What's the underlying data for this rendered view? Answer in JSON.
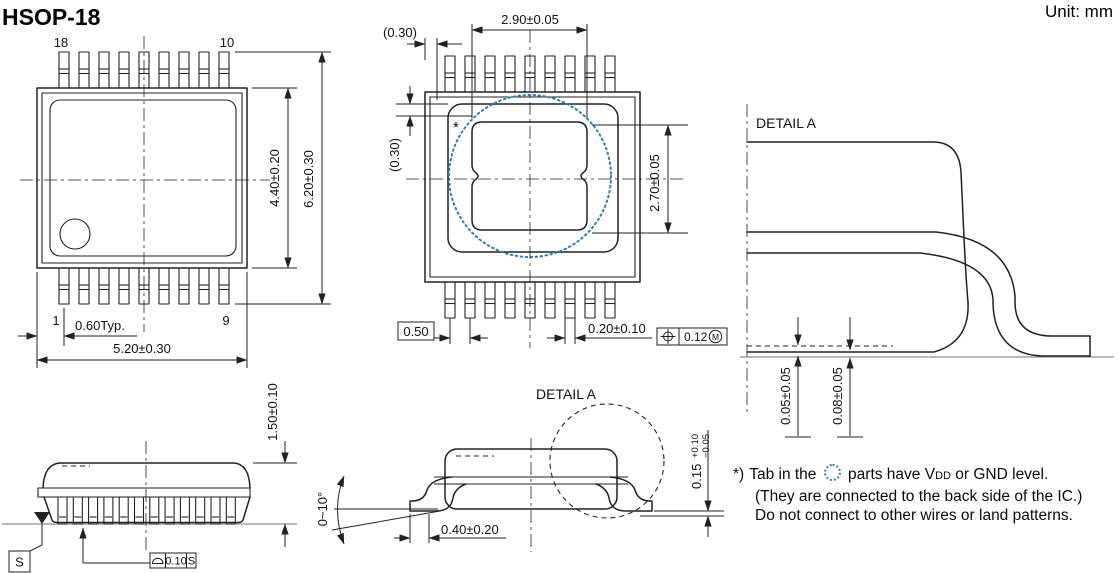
{
  "title": "HSOP-18",
  "unit_label": "Unit: mm",
  "colors": {
    "line": "#222222",
    "accent_blue": "#2e7eb3"
  },
  "top_view": {
    "pin_label_top_left": "18",
    "pin_label_top_right": "10",
    "pin_label_bottom_left": "1",
    "pin_label_bottom_right": "9",
    "dim_lead_offset": "0.60Typ.",
    "dim_overall_width": "5.20±0.30",
    "dim_body_depth": "4.40±0.20",
    "dim_overall_depth": "6.20±0.30"
  },
  "bottom_view": {
    "dim_pad_width": "2.90±0.05",
    "dim_edge_clearance_h": "(0.30)",
    "dim_edge_clearance_v": "(0.30)",
    "dim_pad_height": "2.70±0.05",
    "dim_lead_pitch": "0.50",
    "dim_lead_width": "0.20±0.10",
    "position_tolerance": "0.12",
    "position_modifier": "M",
    "asterisk_mark": "*"
  },
  "detail_a_view": {
    "label": "DETAIL A",
    "dim_standoff": "0.05±0.05",
    "dim_pad_standoff": "0.08±0.05"
  },
  "front_view": {
    "dim_height": "1.50±0.10",
    "datum_label": "S",
    "flatness_tolerance": "0.10",
    "flatness_datum": "S"
  },
  "side_view": {
    "detail_label": "DETAIL A",
    "dim_lead_angle": "0~10°",
    "dim_foot_length": "0.40±0.20",
    "dim_lead_thickness": "0.15",
    "dim_lead_thickness_plus": "+0.10",
    "dim_lead_thickness_minus": "−0.05"
  },
  "note": {
    "prefix": "*)",
    "line1_before": "Tab in the",
    "line1_after": "parts have V",
    "line1_subscript": "DD",
    "line1_end": "or GND level.",
    "line2": "(They are connected to the back side of the IC.)",
    "line3": "Do not connect to other wires or land patterns."
  }
}
